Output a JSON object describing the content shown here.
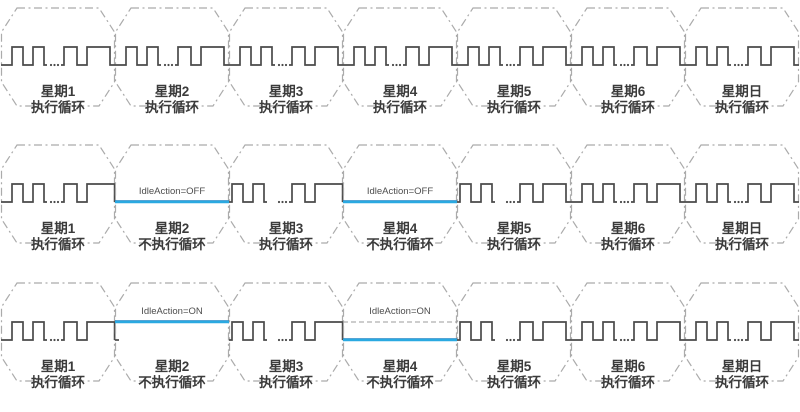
{
  "diagram": {
    "description": "weekly-timer-idle-action-waveform-diagram",
    "colors": {
      "background": "#ffffff",
      "waveform": "#4a4a4a",
      "octagon_outline": "#ababab",
      "idle_line_blue": "#2aa9e1",
      "idle_line_blue_edge": "#1e85c5",
      "ghost_dash_line": "#9b9b9b",
      "label_text": "#3b3b3b",
      "idle_text": "#4d4d4d"
    },
    "rows": [
      {
        "name": "all-days-executing",
        "cells": [
          {
            "day": "星期1",
            "action": "执行循环",
            "mode": "wave"
          },
          {
            "day": "星期2",
            "action": "执行循环",
            "mode": "wave"
          },
          {
            "day": "星期3",
            "action": "执行循环",
            "mode": "wave"
          },
          {
            "day": "星期4",
            "action": "执行循环",
            "mode": "wave"
          },
          {
            "day": "星期5",
            "action": "执行循环",
            "mode": "wave"
          },
          {
            "day": "星期6",
            "action": "执行循环",
            "mode": "wave"
          },
          {
            "day": "星期日",
            "action": "执行循环",
            "mode": "wave"
          }
        ]
      },
      {
        "name": "idle-action-off",
        "cells": [
          {
            "day": "星期1",
            "action": "执行循环",
            "mode": "wave",
            "end_at_boundary": true
          },
          {
            "day": "星期2",
            "action": "不执行循环",
            "mode": "idle",
            "idle_label": "IdleAction=OFF",
            "idle_level": "low"
          },
          {
            "day": "星期3",
            "action": "执行循环",
            "mode": "wave",
            "end_at_boundary": true,
            "start_at_edge": true
          },
          {
            "day": "星期4",
            "action": "不执行循环",
            "mode": "idle",
            "idle_label": "IdleAction=OFF",
            "idle_level": "low"
          },
          {
            "day": "星期5",
            "action": "执行循环",
            "mode": "wave",
            "start_at_edge": true
          },
          {
            "day": "星期6",
            "action": "执行循环",
            "mode": "wave"
          },
          {
            "day": "星期日",
            "action": "执行循环",
            "mode": "wave"
          }
        ]
      },
      {
        "name": "idle-action-on",
        "cells": [
          {
            "day": "星期1",
            "action": "执行循环",
            "mode": "wave",
            "end_at_boundary": true
          },
          {
            "day": "星期2",
            "action": "不执行循环",
            "mode": "idle",
            "idle_label": "IdleAction=ON",
            "idle_level": "high",
            "low_stub": true
          },
          {
            "day": "星期3",
            "action": "执行循环",
            "mode": "wave",
            "end_at_boundary": true,
            "start_at_edge": true
          },
          {
            "day": "星期4",
            "action": "不执行循环",
            "mode": "idle",
            "idle_label": "IdleAction=ON",
            "idle_level": "low",
            "ghost_high_line": true
          },
          {
            "day": "星期5",
            "action": "执行循环",
            "mode": "wave",
            "start_at_edge": true
          },
          {
            "day": "星期6",
            "action": "执行循环",
            "mode": "wave"
          },
          {
            "day": "星期日",
            "action": "执行循环",
            "mode": "wave"
          }
        ]
      }
    ]
  }
}
